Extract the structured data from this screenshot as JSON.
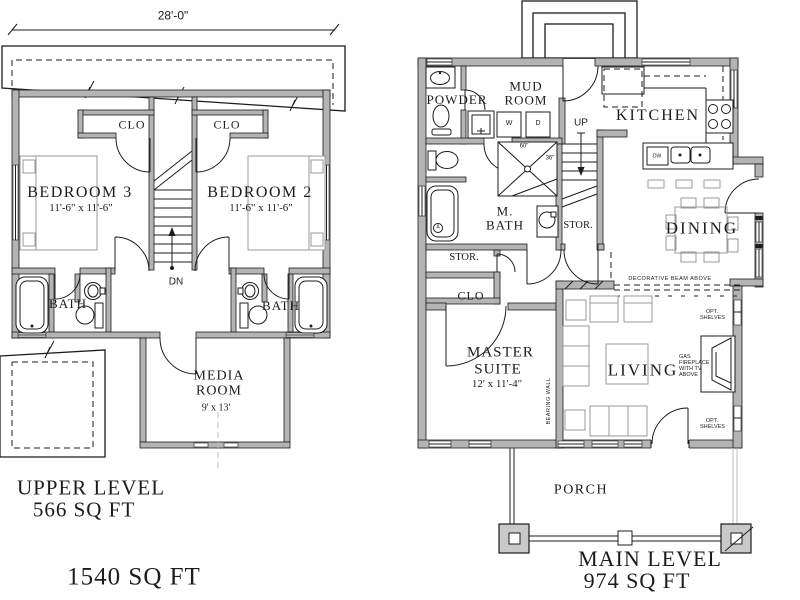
{
  "colors": {
    "background": "#ffffff",
    "line": "#1c1c1c",
    "wall": "#b4b4b4",
    "furniture": "#9a9a9a",
    "column": "#c9c9c9"
  },
  "upper": {
    "width_dim": "28'-0\"",
    "closet_left": "CLO",
    "closet_right": "CLO",
    "bedroom3": {
      "name": "BEDROOM 3",
      "size": "11'-6\" x 11'-6\""
    },
    "bedroom2": {
      "name": "BEDROOM 2",
      "size": "11'-6\" x 11'-6\""
    },
    "bath_left": "BATH",
    "bath_right": "BATH",
    "media": {
      "name": "MEDIA ROOM",
      "size": "9' x 13'"
    },
    "stair_label": "DN",
    "title": "UPPER LEVEL",
    "area": "566 SQ FT"
  },
  "main": {
    "powder": "POWDER",
    "mud_room": "MUD ROOM",
    "kitchen": "KITCHEN",
    "washer": "W",
    "dryer": "D",
    "dishwasher": "DW",
    "stair_label": "UP",
    "master_bath": "M. BATH",
    "stor_under_stairs": "STOR.",
    "stor_hall": "STOR.",
    "closet": "CLO",
    "master": {
      "name": "MASTER SUITE",
      "size": "12' x 11'-4\""
    },
    "dining": "DINING",
    "living": "LIVING",
    "shower_width": "60\"",
    "shower_depth": "36\"",
    "tub_marker": "A",
    "beam_note": "DECORATIVE BEAM ABOVE",
    "fireplace_note": "GAS FIREPLACE WITH TV ABOVE",
    "shelves_note_top": "OPT. SHELVES",
    "shelves_note_bottom": "OPT. SHELVES",
    "bearing_wall": "BEARING WALL",
    "porch": "PORCH",
    "title": "MAIN LEVEL",
    "area": "974 SQ FT"
  },
  "total_area": "1540 SQ FT"
}
